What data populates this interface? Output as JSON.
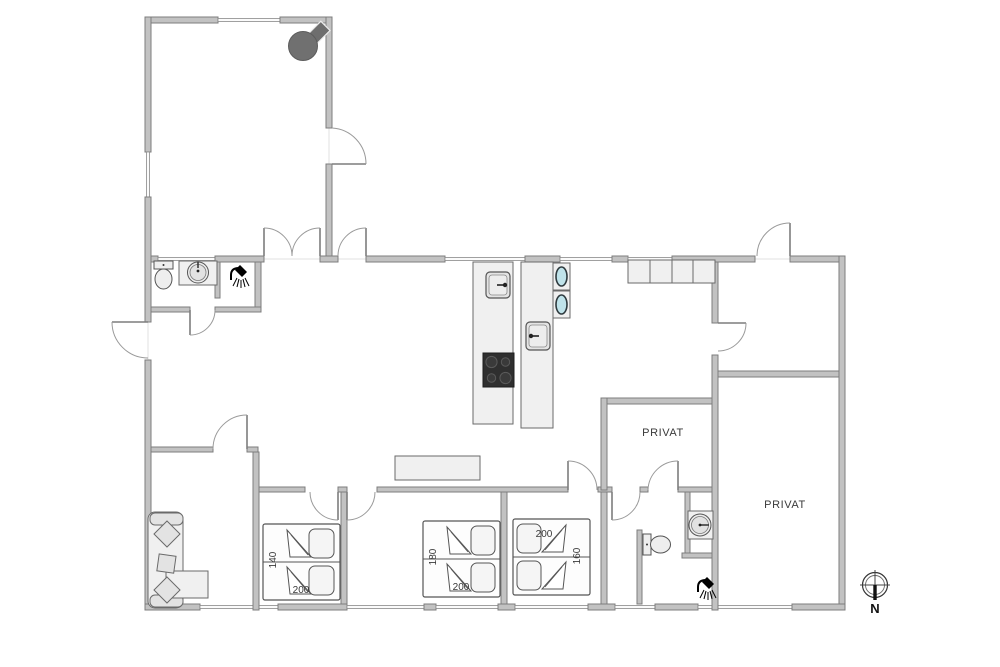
{
  "plan": {
    "labels": {
      "privat_room_1": "PRIVAT",
      "privat_room_2": "PRIVAT",
      "compass_north": "N"
    },
    "beds": {
      "bed_1": {
        "width": "140",
        "length": "200"
      },
      "bed_2": {
        "width": "180",
        "length": "200"
      },
      "bed_3": {
        "width": "160",
        "length": "200"
      }
    },
    "colors": {
      "wall": "#c2c2c2",
      "wall_outline": "#7d7d7d",
      "stove": "#6e6e6e",
      "sink_water": "#bfe3ea",
      "cooktop": "#333333",
      "text": "#3a3a3a"
    }
  }
}
